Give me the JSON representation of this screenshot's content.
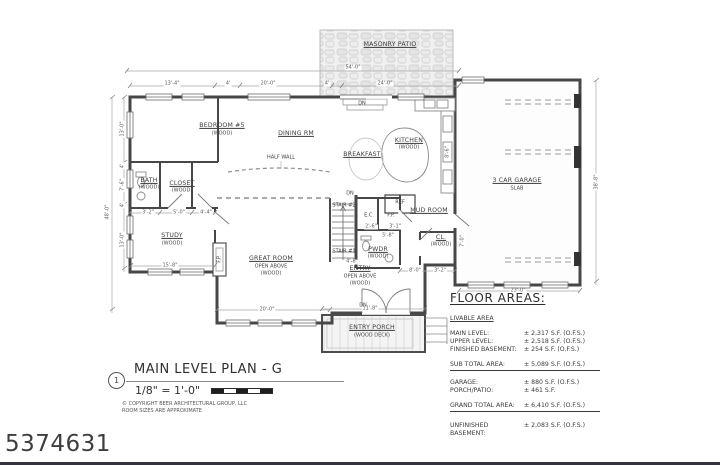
{
  "watermark": "5374631",
  "title_block": {
    "number": "1",
    "title": "MAIN LEVEL PLAN - G",
    "scale": "1/8\" = 1'-0\"",
    "copyright": "© COPYRIGHT BEER ARCHITECTURAL GROUP, LLC",
    "note": "ROOM SIZES ARE APPROXIMATE"
  },
  "floor_areas": {
    "heading": "FLOOR AREAS:",
    "subheading": "LIVABLE AREA",
    "rows": [
      {
        "label": "MAIN LEVEL:",
        "value": "± 2,317 S.F. (O.F.S.)"
      },
      {
        "label": "UPPER LEVEL:",
        "value": "± 2,518 S.F. (O.F.S.)"
      },
      {
        "label": "FINISHED BASEMENT:",
        "value": "± 254 S.F. (O.F.S.)"
      }
    ],
    "subtotal": {
      "label": "SUB TOTAL AREA:",
      "value": "± 5,089 S.F. (O.F.S.)"
    },
    "extra_rows": [
      {
        "label": "GARAGE:",
        "value": "± 880 S.F. (O.F.S.)"
      },
      {
        "label": "PORCH/PATIO:",
        "value": "± 461 S.F."
      }
    ],
    "grand_total": {
      "label": "GRAND TOTAL AREA:",
      "value": "± 6,410 S.F. (O.F.S.)"
    },
    "basement": {
      "label": "UNFINISHED BASEMENT:",
      "value": "± 2,083 S.F. (O.F.S.)"
    }
  },
  "plan": {
    "labels": [
      {
        "t": "MASONRY PATIO",
        "x": 390,
        "y": 45,
        "c": "room",
        "n": "room-label-masonry-patio"
      },
      {
        "t": "BEDROOM #5",
        "x": 222,
        "y": 126,
        "c": "room",
        "n": "room-label-bedroom5"
      },
      {
        "t": "(WOOD)",
        "x": 222,
        "y": 134,
        "c": "sub",
        "n": "floor-note"
      },
      {
        "t": "DINING RM",
        "x": 296,
        "y": 134,
        "c": "room",
        "n": "room-label-dining"
      },
      {
        "t": "BREAKFAST",
        "x": 362,
        "y": 155,
        "c": "room",
        "n": "room-label-breakfast"
      },
      {
        "t": "KITCHEN",
        "x": 409,
        "y": 141,
        "c": "room",
        "n": "room-label-kitchen"
      },
      {
        "t": "(WOOD)",
        "x": 409,
        "y": 148,
        "c": "sub",
        "n": "floor-note"
      },
      {
        "t": "BATH",
        "x": 149,
        "y": 181,
        "c": "room",
        "n": "room-label-bath"
      },
      {
        "t": "(WOOD)",
        "x": 149,
        "y": 188,
        "c": "sub",
        "n": "floor-note"
      },
      {
        "t": "CLOSET",
        "x": 182,
        "y": 184,
        "c": "room",
        "n": "room-label-closet"
      },
      {
        "t": "(WOOD)",
        "x": 182,
        "y": 191,
        "c": "sub",
        "n": "floor-note"
      },
      {
        "t": "STUDY",
        "x": 172,
        "y": 236,
        "c": "room",
        "n": "room-label-study"
      },
      {
        "t": "(WOOD)",
        "x": 172,
        "y": 244,
        "c": "sub",
        "n": "floor-note"
      },
      {
        "t": "GREAT ROOM",
        "x": 271,
        "y": 259,
        "c": "room",
        "n": "room-label-great-room"
      },
      {
        "t": "OPEN ABOVE",
        "x": 271,
        "y": 267,
        "c": "sub",
        "n": "open-above-note"
      },
      {
        "t": "(WOOD)",
        "x": 271,
        "y": 274,
        "c": "sub",
        "n": "floor-note"
      },
      {
        "t": "ENTRY",
        "x": 360,
        "y": 269,
        "c": "room",
        "n": "room-label-entry"
      },
      {
        "t": "OPEN ABOVE",
        "x": 360,
        "y": 277,
        "c": "sub",
        "n": "open-above-note"
      },
      {
        "t": "(WOOD)",
        "x": 360,
        "y": 284,
        "c": "sub",
        "n": "floor-note"
      },
      {
        "t": "PWDR",
        "x": 378,
        "y": 250,
        "c": "room",
        "n": "room-label-powder"
      },
      {
        "t": "(WOOD)",
        "x": 378,
        "y": 257,
        "c": "sub",
        "n": "floor-note"
      },
      {
        "t": "MUD ROOM",
        "x": 429,
        "y": 211,
        "c": "room",
        "n": "room-label-mud-room"
      },
      {
        "t": "CL.",
        "x": 441,
        "y": 238,
        "c": "room",
        "n": "room-label-cl"
      },
      {
        "t": "(WOOD)",
        "x": 441,
        "y": 245,
        "c": "sub",
        "n": "floor-note"
      },
      {
        "t": "3 CAR GARAGE",
        "x": 517,
        "y": 181,
        "c": "room",
        "n": "room-label-garage"
      },
      {
        "t": "SLAB",
        "x": 517,
        "y": 189,
        "c": "sub",
        "n": "floor-note"
      },
      {
        "t": "ENTRY PORCH",
        "x": 372,
        "y": 328,
        "c": "room",
        "n": "room-label-entry-porch"
      },
      {
        "t": "(WOOD DECK)",
        "x": 372,
        "y": 336,
        "c": "sub",
        "n": "floor-note"
      },
      {
        "t": "HALF WALL",
        "x": 281,
        "y": 158,
        "c": "ann",
        "n": "half-wall-note"
      },
      {
        "t": "STAIR #2",
        "x": 344,
        "y": 206,
        "c": "ann",
        "n": "stair2-note"
      },
      {
        "t": "STAIR #1",
        "x": 344,
        "y": 252,
        "c": "ann",
        "n": "stair1-note"
      },
      {
        "t": "REF",
        "x": 400,
        "y": 203,
        "c": "ann",
        "n": "ref-note"
      },
      {
        "t": "E.C.",
        "x": 369,
        "y": 216,
        "c": "ann",
        "n": "ec-note"
      },
      {
        "t": "F.P.",
        "x": 391,
        "y": 216,
        "c": "ann",
        "n": "fp-closet-note"
      },
      {
        "t": "F.P.",
        "x": 220,
        "y": 259,
        "c": "ann",
        "r": 1,
        "n": "fireplace-note"
      },
      {
        "t": "DN",
        "x": 362,
        "y": 104,
        "c": "ann",
        "n": "dn-note"
      },
      {
        "t": "DN",
        "x": 350,
        "y": 194,
        "c": "ann",
        "n": "dn-note"
      },
      {
        "t": "DN",
        "x": 363,
        "y": 306,
        "c": "ann",
        "n": "dn-note"
      },
      {
        "t": "54'-0\"",
        "x": 353,
        "y": 68,
        "c": "dim",
        "n": "dim-label"
      },
      {
        "t": "13'-4\"",
        "x": 172,
        "y": 84,
        "c": "dim",
        "n": "dim-label"
      },
      {
        "t": "4'",
        "x": 228,
        "y": 84,
        "c": "dim",
        "n": "dim-label"
      },
      {
        "t": "20'-0\"",
        "x": 268,
        "y": 84,
        "c": "dim",
        "n": "dim-label"
      },
      {
        "t": "4'",
        "x": 327,
        "y": 84,
        "c": "dim",
        "n": "dim-label"
      },
      {
        "t": "24'-0\"",
        "x": 385,
        "y": 84,
        "c": "dim",
        "n": "dim-label"
      },
      {
        "t": "48'-0\"",
        "x": 108,
        "y": 212,
        "c": "dim",
        "r": 1,
        "n": "dim-label"
      },
      {
        "t": "13'-0\"",
        "x": 123,
        "y": 129,
        "c": "dim",
        "r": 1,
        "n": "dim-label"
      },
      {
        "t": "4'",
        "x": 123,
        "y": 166,
        "c": "dim",
        "r": 1,
        "n": "dim-label"
      },
      {
        "t": "7'-6\"",
        "x": 123,
        "y": 185,
        "c": "dim",
        "r": 1,
        "n": "dim-label"
      },
      {
        "t": "4'",
        "x": 123,
        "y": 205,
        "c": "dim",
        "r": 1,
        "n": "dim-label"
      },
      {
        "t": "13'-0\"",
        "x": 123,
        "y": 240,
        "c": "dim",
        "r": 1,
        "n": "dim-label"
      },
      {
        "t": "38'-8\"",
        "x": 597,
        "y": 182,
        "c": "dim",
        "r": 1,
        "n": "dim-label"
      },
      {
        "t": "23'-0\"",
        "x": 518,
        "y": 291,
        "c": "dim",
        "n": "dim-label"
      },
      {
        "t": "20'-0\"",
        "x": 267,
        "y": 310,
        "c": "dim",
        "n": "dim-label"
      },
      {
        "t": "15'-8\"",
        "x": 170,
        "y": 266,
        "c": "dim",
        "n": "dim-label"
      },
      {
        "t": "3'-2\"",
        "x": 148,
        "y": 213,
        "c": "dim",
        "n": "dim-label"
      },
      {
        "t": "5'-0\"",
        "x": 179,
        "y": 213,
        "c": "dim",
        "n": "dim-label"
      },
      {
        "t": "4'-4\"",
        "x": 206,
        "y": 213,
        "c": "dim",
        "n": "dim-label"
      },
      {
        "t": "11'-8\"",
        "x": 370,
        "y": 309,
        "c": "dim",
        "n": "dim-label"
      },
      {
        "t": "8'-0\"",
        "x": 415,
        "y": 271,
        "c": "dim",
        "n": "dim-label"
      },
      {
        "t": "3'-2\"",
        "x": 440,
        "y": 271,
        "c": "dim",
        "n": "dim-label"
      },
      {
        "t": "7'-0\"",
        "x": 463,
        "y": 241,
        "c": "dim",
        "r": 1,
        "n": "dim-label"
      },
      {
        "t": "4'-8\"",
        "x": 352,
        "y": 262,
        "c": "dim",
        "n": "dim-label"
      },
      {
        "t": "5'-8\"",
        "x": 388,
        "y": 236,
        "c": "dim",
        "n": "dim-label"
      },
      {
        "t": "2'-6\"",
        "x": 371,
        "y": 227,
        "c": "dim",
        "n": "dim-label"
      },
      {
        "t": "3'-1\"",
        "x": 395,
        "y": 227,
        "c": "dim",
        "n": "dim-label"
      },
      {
        "t": "8'-6\"",
        "x": 448,
        "y": 152,
        "c": "dim",
        "r": 1,
        "n": "dim-label"
      }
    ]
  }
}
